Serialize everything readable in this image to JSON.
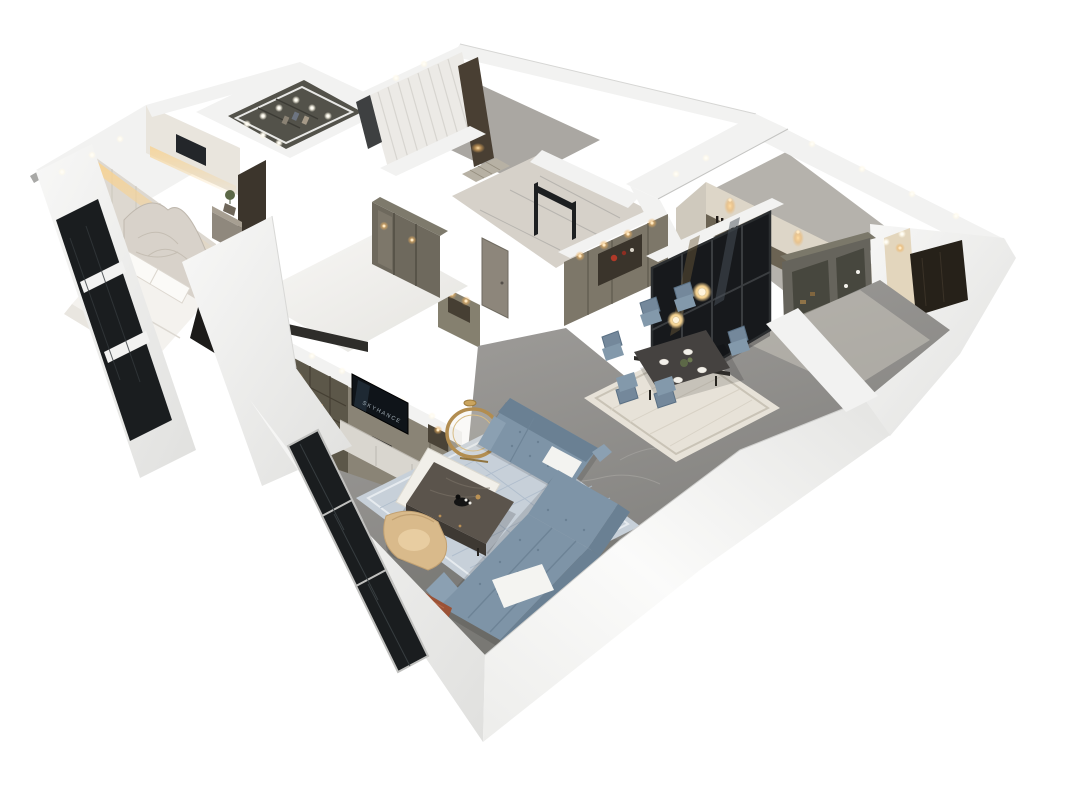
{
  "scene": {
    "description": "Photorealistic 3D isometric cutaway (dollhouse) render of an apartment floor plan viewed from above on a plain white background",
    "view": "axonometric top-down cutaway",
    "background": "#ffffff",
    "tv_logo_text": "SKYHANCE"
  },
  "palette": {
    "background": "#ffffff",
    "wall": "#f2f2f1",
    "wallShade": "#e3e3e1",
    "wallDark": "#cfcfcd",
    "wallEdge": "#c6c6c4",
    "floorGray": "#8c8b89",
    "floorKitchen": "#b5b2ac",
    "marbleHall": "#d6d1c9",
    "marbleVein": "#a8a6a2",
    "floorWhite": "#f4f3f0",
    "cabinetTaupe": "#8a8476",
    "cabinetTaupeDark": "#5c5749",
    "cabinetSeam": "#6f6a5d",
    "cabinetOlive": "#66645c",
    "cabinetDarkWood": "#493f33",
    "closetInterior": "#53524a",
    "glassDark": "#17191c",
    "glassFrame": "#3a3d40",
    "windowGlass": "#1a1d1f",
    "sofaBlue": "#7e94a7",
    "sofaBlueDark": "#6a8093",
    "rugLiving": "#c7d0d9",
    "rugPattern": "#aebccb",
    "rugDining": "#e7e2d8",
    "tableDark": "#454240",
    "chairBlue": "#74889b",
    "chairSeat": "#8399ab",
    "tanChair": "#d9ba8b",
    "gold": "#b28d50",
    "bedWhite": "#f4f2ee",
    "headboard": "#d8d2ca",
    "warmLight": "#eeb15e",
    "redDecor": "#b03928",
    "greenPlant": "#5c6847",
    "throwRust": "#9b5236",
    "whitePad": "#f3f3f0",
    "tvScreen": "#0f1419",
    "tvLogoColor": "#b9c6ce",
    "downlight": "#fffdf5"
  },
  "rooms": [
    {
      "name": "master-bedroom",
      "key_features": [
        "quilted curved headboard bed",
        "white bedding and pillows",
        "backlit textured feature wall with warm cove light",
        "marble wall with small TV",
        "nightstand with plant",
        "dark floor-to-ceiling window glazing"
      ]
    },
    {
      "name": "walk-in-closet",
      "key_features": [
        "dark olive wardrobe interior seen through ceiling opening",
        "ring of recessed downlights"
      ]
    },
    {
      "name": "second-bedroom",
      "key_features": [
        "bright white floor",
        "glass-front wardrobe with warm lighting",
        "dark door opening"
      ]
    },
    {
      "name": "curtained-room",
      "key_features": [
        "sheer white curtains",
        "dark wood cabinet with warm light",
        "gray floor"
      ]
    },
    {
      "name": "entry-hallway",
      "key_features": [
        "light marble floor",
        "patterned door mat",
        "black-framed glass partition",
        "taupe interior door",
        "lit shoe cabinet niche"
      ]
    },
    {
      "name": "kitchen",
      "key_features": [
        "warm downlit cabinetry wall",
        "wine bottle shelf",
        "white perimeter walls"
      ]
    },
    {
      "name": "dining-room",
      "key_features": [
        "dark six-seat dining table with white place settings",
        "six blue upholstered chairs",
        "ivory area rug",
        "two glowing globe pendant lights",
        "sideboard with red decor niche and warm downlights",
        "black-framed glass sliding partition"
      ]
    },
    {
      "name": "study-corridor",
      "key_features": [
        "smoked-glass display cabinet",
        "dark paneled doorway",
        "warm accent wall",
        "light marble floor"
      ]
    },
    {
      "name": "living-room",
      "key_features": [
        "taupe media wall with open shelving and warm downlights",
        "TV with glowing logo",
        "white media cabinets",
        "gray marble floor",
        "patterned blue rug with layered white rug",
        "L-shaped blue tufted sectional sofa",
        "white throw pads",
        "rust fringed throw on armrest",
        "dark marble coffee table with black decor tray",
        "round gold-framed mirror",
        "gold dish",
        "tan barrel lounge chair",
        "floor-to-ceiling window wall",
        "white exterior walls"
      ]
    }
  ],
  "lighting": {
    "ceiling": "small recessed white downlights along wall tops",
    "accent": "warm cove and cabinet accent lighting",
    "pendants": "two glowing globe pendants above the dining table"
  }
}
